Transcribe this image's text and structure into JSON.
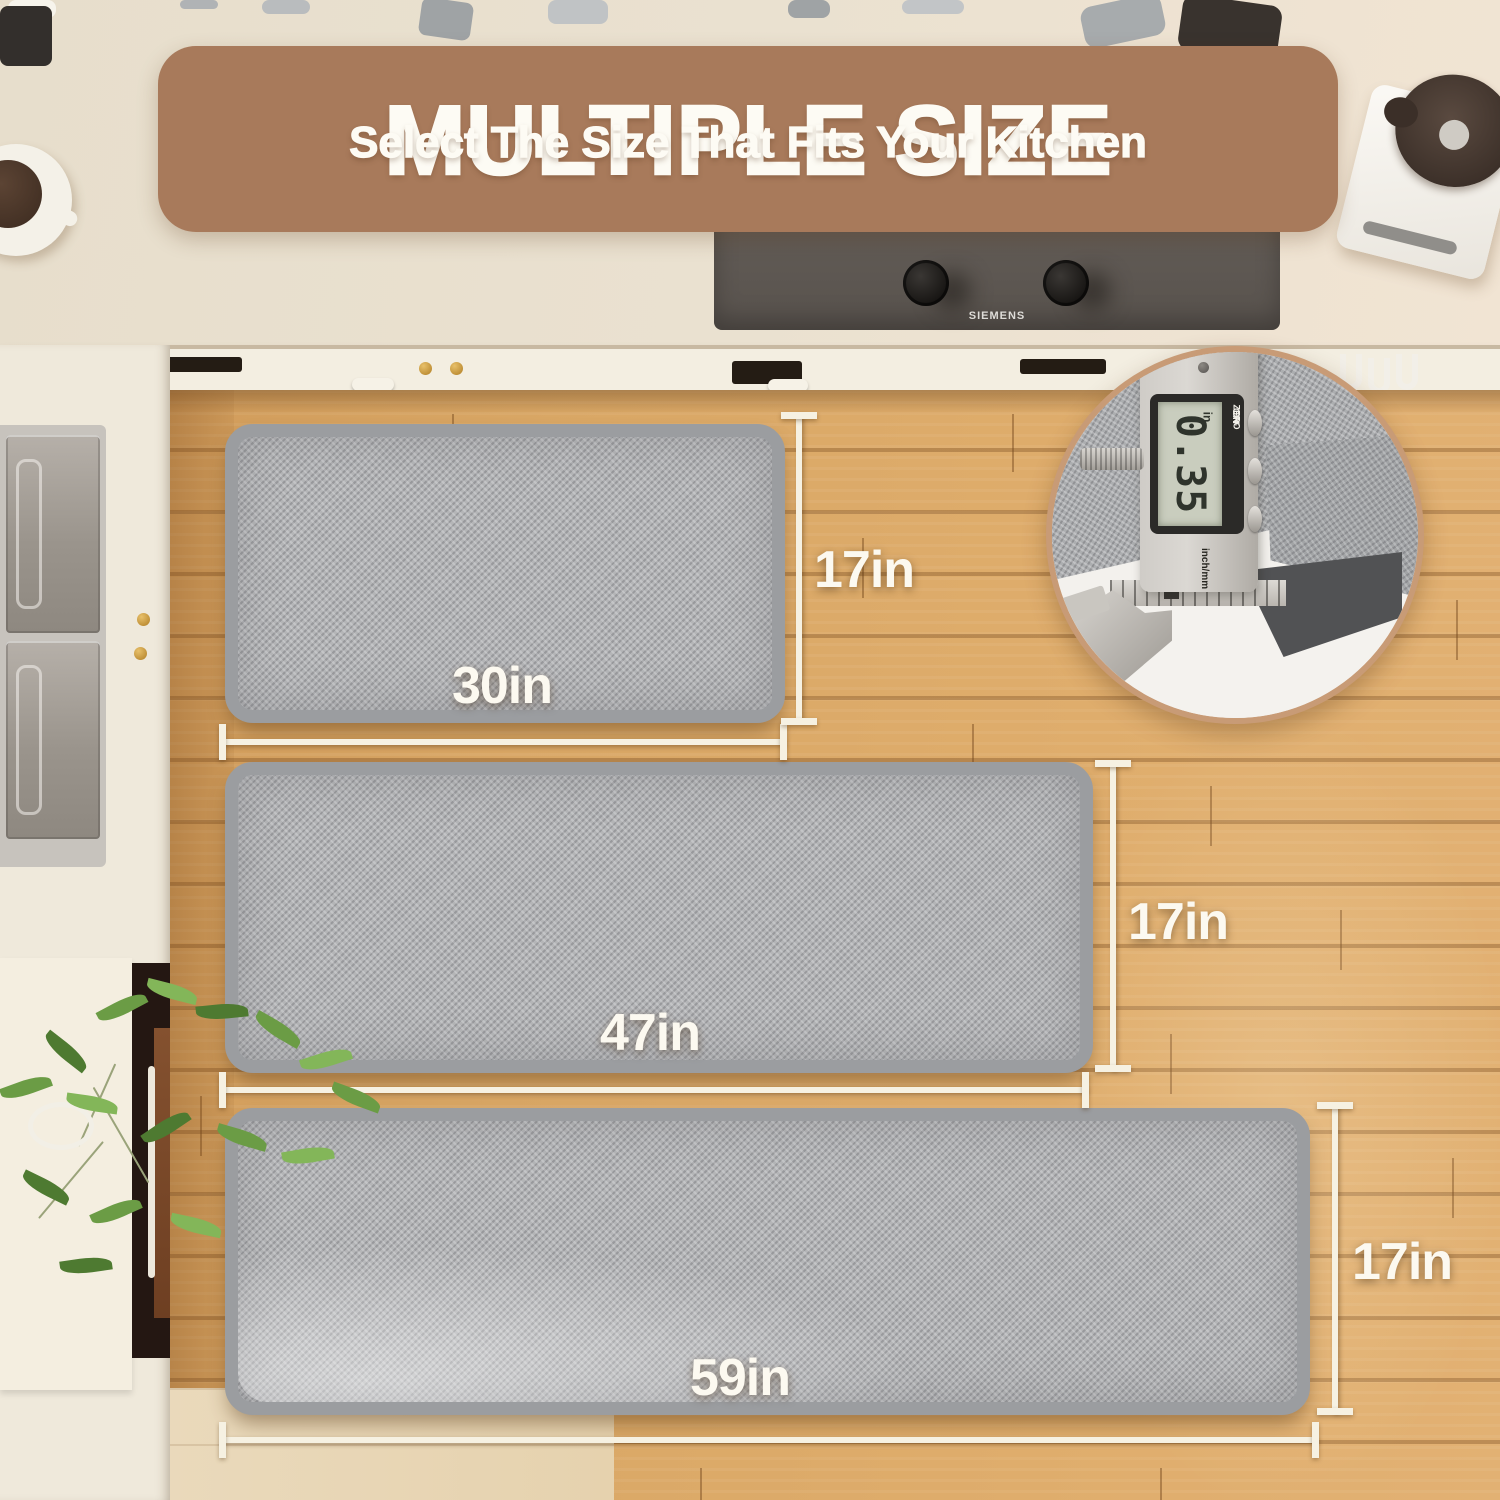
{
  "banner": {
    "title": "MULTIPLE SIZE",
    "subtitle": "Select The Size That Fits Your Kitchen"
  },
  "mats": {
    "small": {
      "width_label": "30in",
      "height_label": "17in"
    },
    "medium": {
      "width_label": "47in",
      "height_label": "17in"
    },
    "large": {
      "width_label": "59in",
      "height_label": "17in"
    }
  },
  "inset": {
    "reading": "0.35",
    "unit": "in",
    "buttons": [
      "ZERO",
      "ON",
      "OFF"
    ],
    "mode_label": "inch/mm"
  },
  "appliances": {
    "cooktop_brand": "SIEMENS"
  },
  "colors": {
    "banner_bg": "#A87A5B",
    "text": "#FDFBF4",
    "floor": "#D8A263",
    "mat_border": "#9B9DA0",
    "mat_surface": "#B4B5B7",
    "dimension_line": "#F6F1E2",
    "inset_border": "#C89B76"
  }
}
